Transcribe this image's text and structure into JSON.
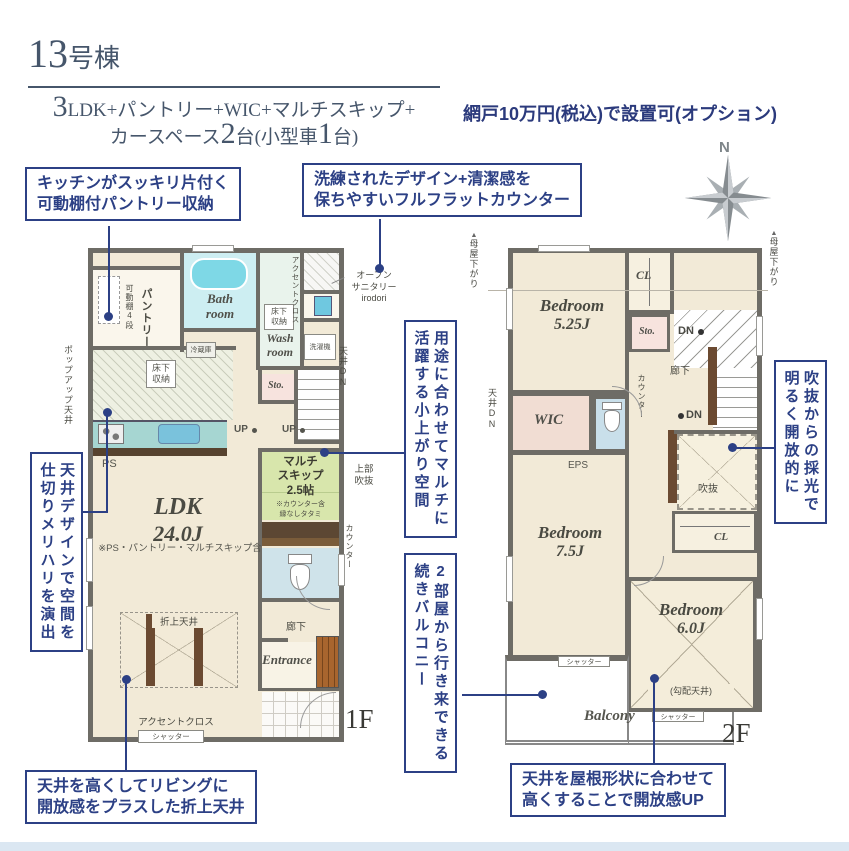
{
  "colors": {
    "accent": "#2c4085"
  },
  "header": {
    "building_num": "13",
    "building_suffix": "号棟",
    "spec": {
      "num1": "3",
      "rest1": "LDK+パントリー+WIC+マルチスキップ+",
      "pre2": "カースペース",
      "num2": "2",
      "mid2": "台(小型車",
      "num3": "1",
      "end2": "台)"
    },
    "option": "網戸10万円(税込)で設置可(オプション)",
    "compass_n": "N"
  },
  "callouts": {
    "pantry_storage": "キッチンがスッキリ片付く\n可動棚付パントリー収納",
    "flat_counter": "洗練されたデザイン+清潔感を\n保ちやすいフルフラットカウンター",
    "ceiling_design": "天井デザインで空間を\n仕切りメリハリを演出",
    "multi_space": "用途に合わせてマルチに\n活躍する小上がり空間",
    "balcony_access": "2部屋から行き来できる\n続きバルコニー",
    "void_light": "吹抜からの採光で\n明るく開放的に",
    "folded_ceiling": "天井を高くしてリビングに\n開放感をプラスした折上天井",
    "roof_ceiling": "天井を屋根形状に合わせて\n高くすることで開放感UP"
  },
  "floor1": {
    "tag": "1F",
    "pantry_shelf": "可動棚4段",
    "pantry": "パントリー",
    "popup_ceiling": "ポップアップ天井",
    "bath": "Bath\nroom",
    "wash": "Wash\nroom",
    "accent_top": "アクセントクロス",
    "open_sanitary": "オープン\nサニタリー\nirodori",
    "washer": "洗濯機",
    "underfloor_wash": "床下\n収納",
    "underfloor_kitchen": "床下\n収納",
    "fridge": "冷蔵庫",
    "ceiling_dn": "天井DN",
    "sto": "Sto.",
    "up1": "UP",
    "up2": "UP",
    "ps": "PS",
    "ldk": "LDK",
    "ldk_size": "24.0J",
    "ldk_note": "※PS・パントリー・マルチスキップ含",
    "multi": "マルチ\nスキップ\n2.5帖",
    "multi_note": "※カウンター含\n縁なしタタミ",
    "upper_void": "上部\n吹抜",
    "counter": "カウンター",
    "oriage": "折上天井",
    "hallway": "廊下",
    "entrance": "Entrance",
    "accent_bottom": "アクセントクロス",
    "shutter": "シャッター"
  },
  "floor2": {
    "tag": "2F",
    "moya_left": "母屋下がり",
    "moya_right": "母屋下がり",
    "bed1": "Bedroom",
    "bed1_size": "5.25J",
    "cl1": "CL",
    "sto": "Sto.",
    "dn1": "DN",
    "dn2": "DN",
    "hallway": "廊下",
    "counter": "カウンター",
    "ceiling_dn": "天井DN",
    "wic": "WIC",
    "eps": "EPS",
    "void_label": "吹抜",
    "bed2": "Bedroom",
    "bed2_size": "7.5J",
    "cl2": "CL",
    "bed3": "Bedroom",
    "bed3_size": "6.0J",
    "slope": "(勾配天井)",
    "shutter1": "シャッター",
    "shutter2": "シャッター",
    "balcony": "Balcony"
  }
}
